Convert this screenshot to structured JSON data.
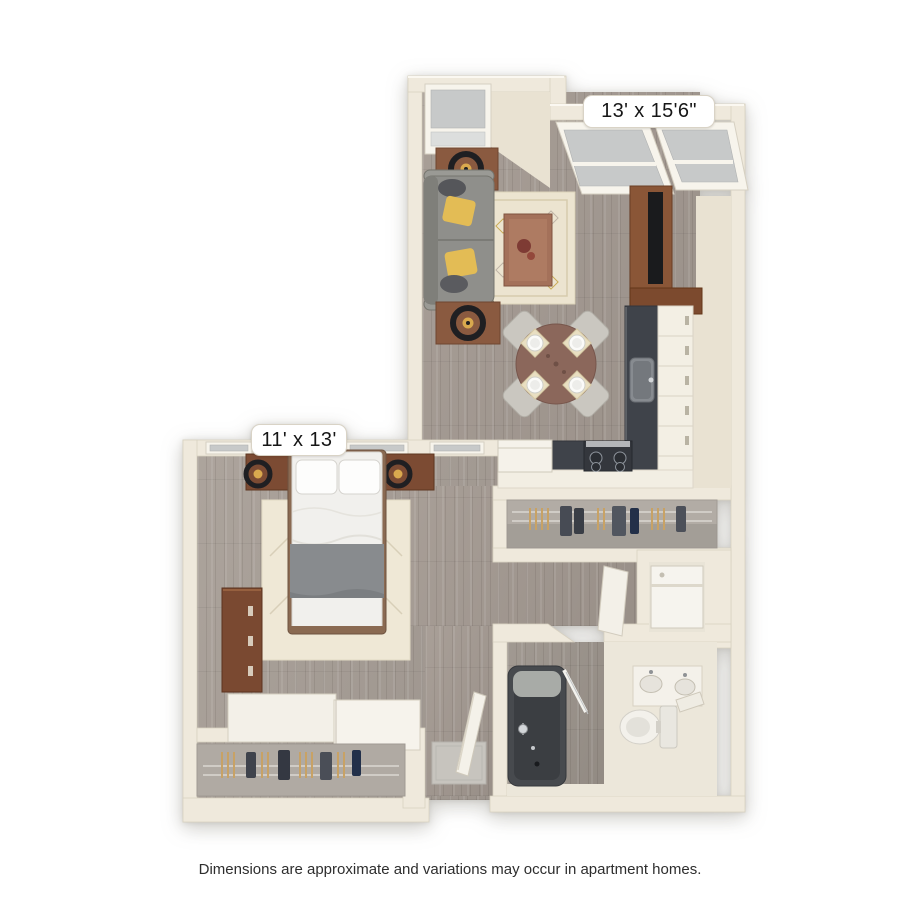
{
  "labels": {
    "living": "13' x 15'6\"",
    "bedroom": "11' x 13'"
  },
  "footer": "Dimensions are approximate and variations may occur in apartment homes.",
  "palette": {
    "page_bg": "#ffffff",
    "wall": "#efe9dc",
    "wall_shade": "#e9e2d2",
    "wall_edge": "#d8d1c1",
    "floor_wood": "#a49a92",
    "floor_wood_bed": "#a89f97",
    "floor_bath": "#9c948c",
    "rug": "#ece4d0",
    "rug_bed": "#efe8d6",
    "sofa": "#8f8f8b",
    "pillow_yellow": "#e3bc55",
    "pillow_gray": "#55565a",
    "wood_dark": "#7c4b33",
    "wood_console": "#8a5637",
    "table_wood": "#8b675b",
    "counter_dark": "#3f434a",
    "cabinet_white": "#f3efe4",
    "chair": "#cac7c0",
    "mattress": "#f1f0ed",
    "blanket": "#888b8e",
    "closet_interior": "#b2aca5",
    "fixture_white": "#f4f1ea",
    "tub_dark": "#474a4e",
    "glass": "#c7c9c9",
    "lamp_black": "#1f1f22",
    "lamp_gold": "#d9a94e",
    "hanger_tan": "#c8a265",
    "label_text": "#161616",
    "footer_text": "#2e2e2e"
  }
}
